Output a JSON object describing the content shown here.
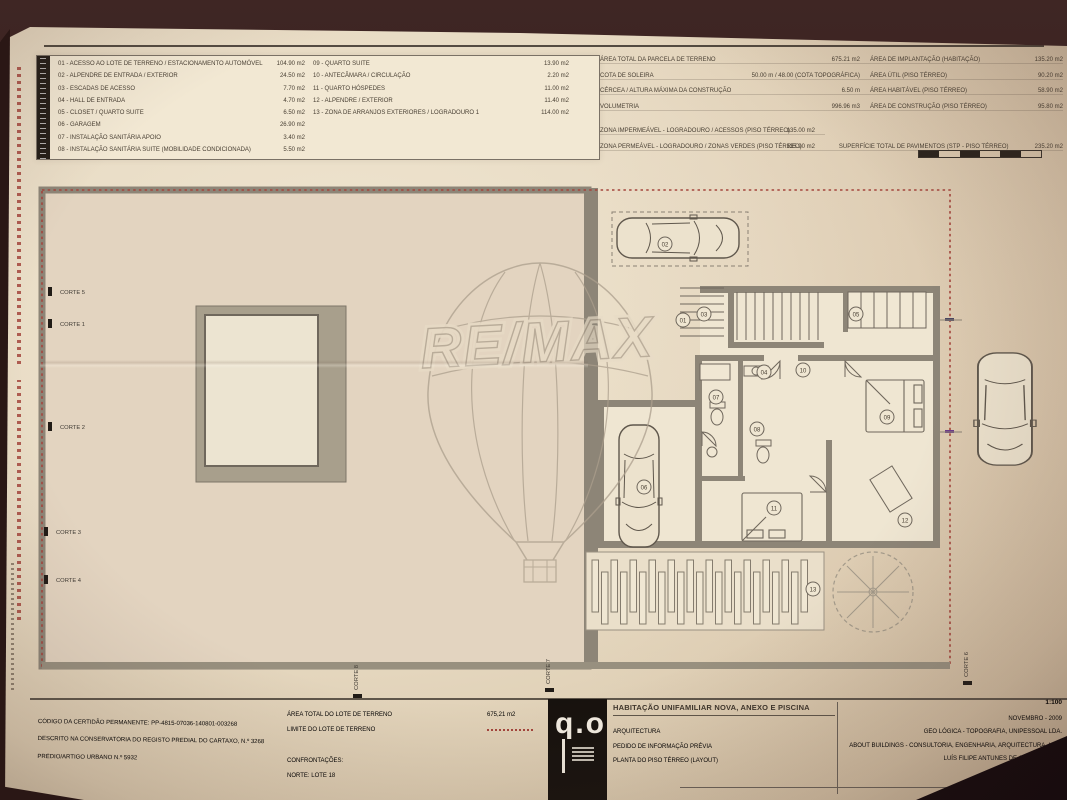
{
  "sheet": {
    "watermark": {
      "brand": "RE/MAX"
    },
    "legend": {
      "left": [
        {
          "label": "01 - ACESSO AO LOTE DE TERRENO / ESTACIONAMENTO AUTOMÓVEL",
          "value": "104.90 m2"
        },
        {
          "label": "02 - ALPENDRE DE ENTRADA / EXTERIOR",
          "value": "24.50 m2"
        },
        {
          "label": "03 - ESCADAS DE ACESSO",
          "value": "7.70 m2"
        },
        {
          "label": "04 - HALL DE ENTRADA",
          "value": "4.70 m2"
        },
        {
          "label": "05 - CLOSET / QUARTO SUITE",
          "value": "6.50 m2"
        },
        {
          "label": "06 - GARAGEM",
          "value": "26.90 m2"
        },
        {
          "label": "07 - INSTALAÇÃO SANITÁRIA APOIO",
          "value": "3.40 m2"
        },
        {
          "label": "08 - INSTALAÇÃO SANITÁRIA SUITE (MOBILIDADE CONDICIONADA)",
          "value": "5.50 m2"
        }
      ],
      "right": [
        {
          "label": "09 - QUARTO SUITE",
          "value": "13.90 m2"
        },
        {
          "label": "10 - ANTECÂMARA / CIRCULAÇÃO",
          "value": "2.20 m2"
        },
        {
          "label": "11 - QUARTO HÓSPEDES",
          "value": "11.00 m2"
        },
        {
          "label": "12 - ALPENDRE / EXTERIOR",
          "value": "11.40 m2"
        },
        {
          "label": "13 - ZONA DE ARRANJOS EXTERIORES / LOGRADOURO 1",
          "value": "114.00 m2"
        }
      ]
    },
    "site_table": {
      "rows": [
        {
          "l1": "ÁREA TOTAL DA PARCELA DE TERRENO",
          "v1": "675.21 m2",
          "l2": "ÁREA DE IMPLANTAÇÃO (HABITAÇÃO)",
          "v2": "135.20 m2"
        },
        {
          "l1": "COTA DE SOLEIRA",
          "v1": "50.00 m / 48.00 (COTA TOPOGRÁFICA)",
          "l2": "ÁREA ÚTIL (PISO TÉRREO)",
          "v2": "90.20 m2"
        },
        {
          "l1": "CÉRCEA / ALTURA MÁXIMA DA CONSTRUÇÃO",
          "v1": "6.50 m",
          "l2": "ÁREA HABITÁVEL (PISO TÉRREO)",
          "v2": "58.90 m2"
        },
        {
          "l1": "VOLUMETRIA",
          "v1": "996.96 m3",
          "l2": "ÁREA DE CONSTRUÇÃO (PISO TÉRREO)",
          "v2": "95.80 m2"
        }
      ],
      "surface_rows": [
        {
          "l1": "ZONA IMPERMEÁVEL - LOGRADOURO / ACESSOS (PISO TÉRREO)",
          "v1": "135.00 m2",
          "l2": "",
          "v2": ""
        },
        {
          "l1": "ZONA PERMEÁVEL - LOGRADOURO / ZONAS VERDES (PISO TÉRREO)",
          "v1": "135.90 m2",
          "l2": "SUPERFÍCIE TOTAL DE PAVIMENTOS (STP - PISO TÉRREO)",
          "v2": "235.20 m2"
        }
      ]
    },
    "cortes_left": [
      "CORTE 5",
      "CORTE 1",
      "CORTE 2",
      "CORTE 3",
      "CORTE 4"
    ],
    "cortes_bottom": [
      "CORTE 8",
      "CORTE 7",
      "CORTE 6"
    ],
    "plan_markers": [
      "01",
      "02",
      "03",
      "04",
      "05",
      "06",
      "07",
      "08",
      "09",
      "10",
      "11",
      "12",
      "13"
    ],
    "titleblock": {
      "registry_lines": [
        "CÓDIGO DA CERTIDÃO PERMANENTE: PP-4815-07036-140801-003268",
        "DESCRITO NA CONSERVATÓRIA DO REGISTO PREDIAL DO CARTAXO, N.º 3268",
        "PRÉDIO/ARTIGO URBANO N.º 5932"
      ],
      "lot": {
        "area_label": "ÁREA TOTAL DO LOTE DE TERRENO",
        "area_value": "675,21 m2",
        "limit_label": "LIMITE DO LOTE DE TERRENO",
        "confront_label": "CONFRONTAÇÕES:",
        "confront_north": "NORTE: LOTE 18"
      },
      "logo_text": "q.o",
      "project_title": "HABITAÇÃO UNIFAMILIAR NOVA, ANEXO E PISCINA",
      "discipline": "ARQUITECTURA",
      "phase": "PEDIDO DE INFORMAÇÃO PRÉVIA",
      "drawing": "PLANTA DO PISO TÉRREO (LAYOUT)",
      "scale": "1:100",
      "date": "NOVEMBRO - 2009",
      "company_topography": "GEO LÓGICA - TOPOGRAFIA, UNIPESSOAL LDA.",
      "company_engineering": "ABOUT BUILDINGS - CONSULTORIA, ENGENHARIA, ARQUITECTURA, LDA.",
      "architect": "LUÍS FILIPE ANTUNES DE GUERRA, ARQ."
    },
    "colors": {
      "boundary_red": "#a4453c",
      "wall_gray": "#8d8577",
      "paper": "#e8dbc4",
      "ink": "#473e32"
    }
  }
}
